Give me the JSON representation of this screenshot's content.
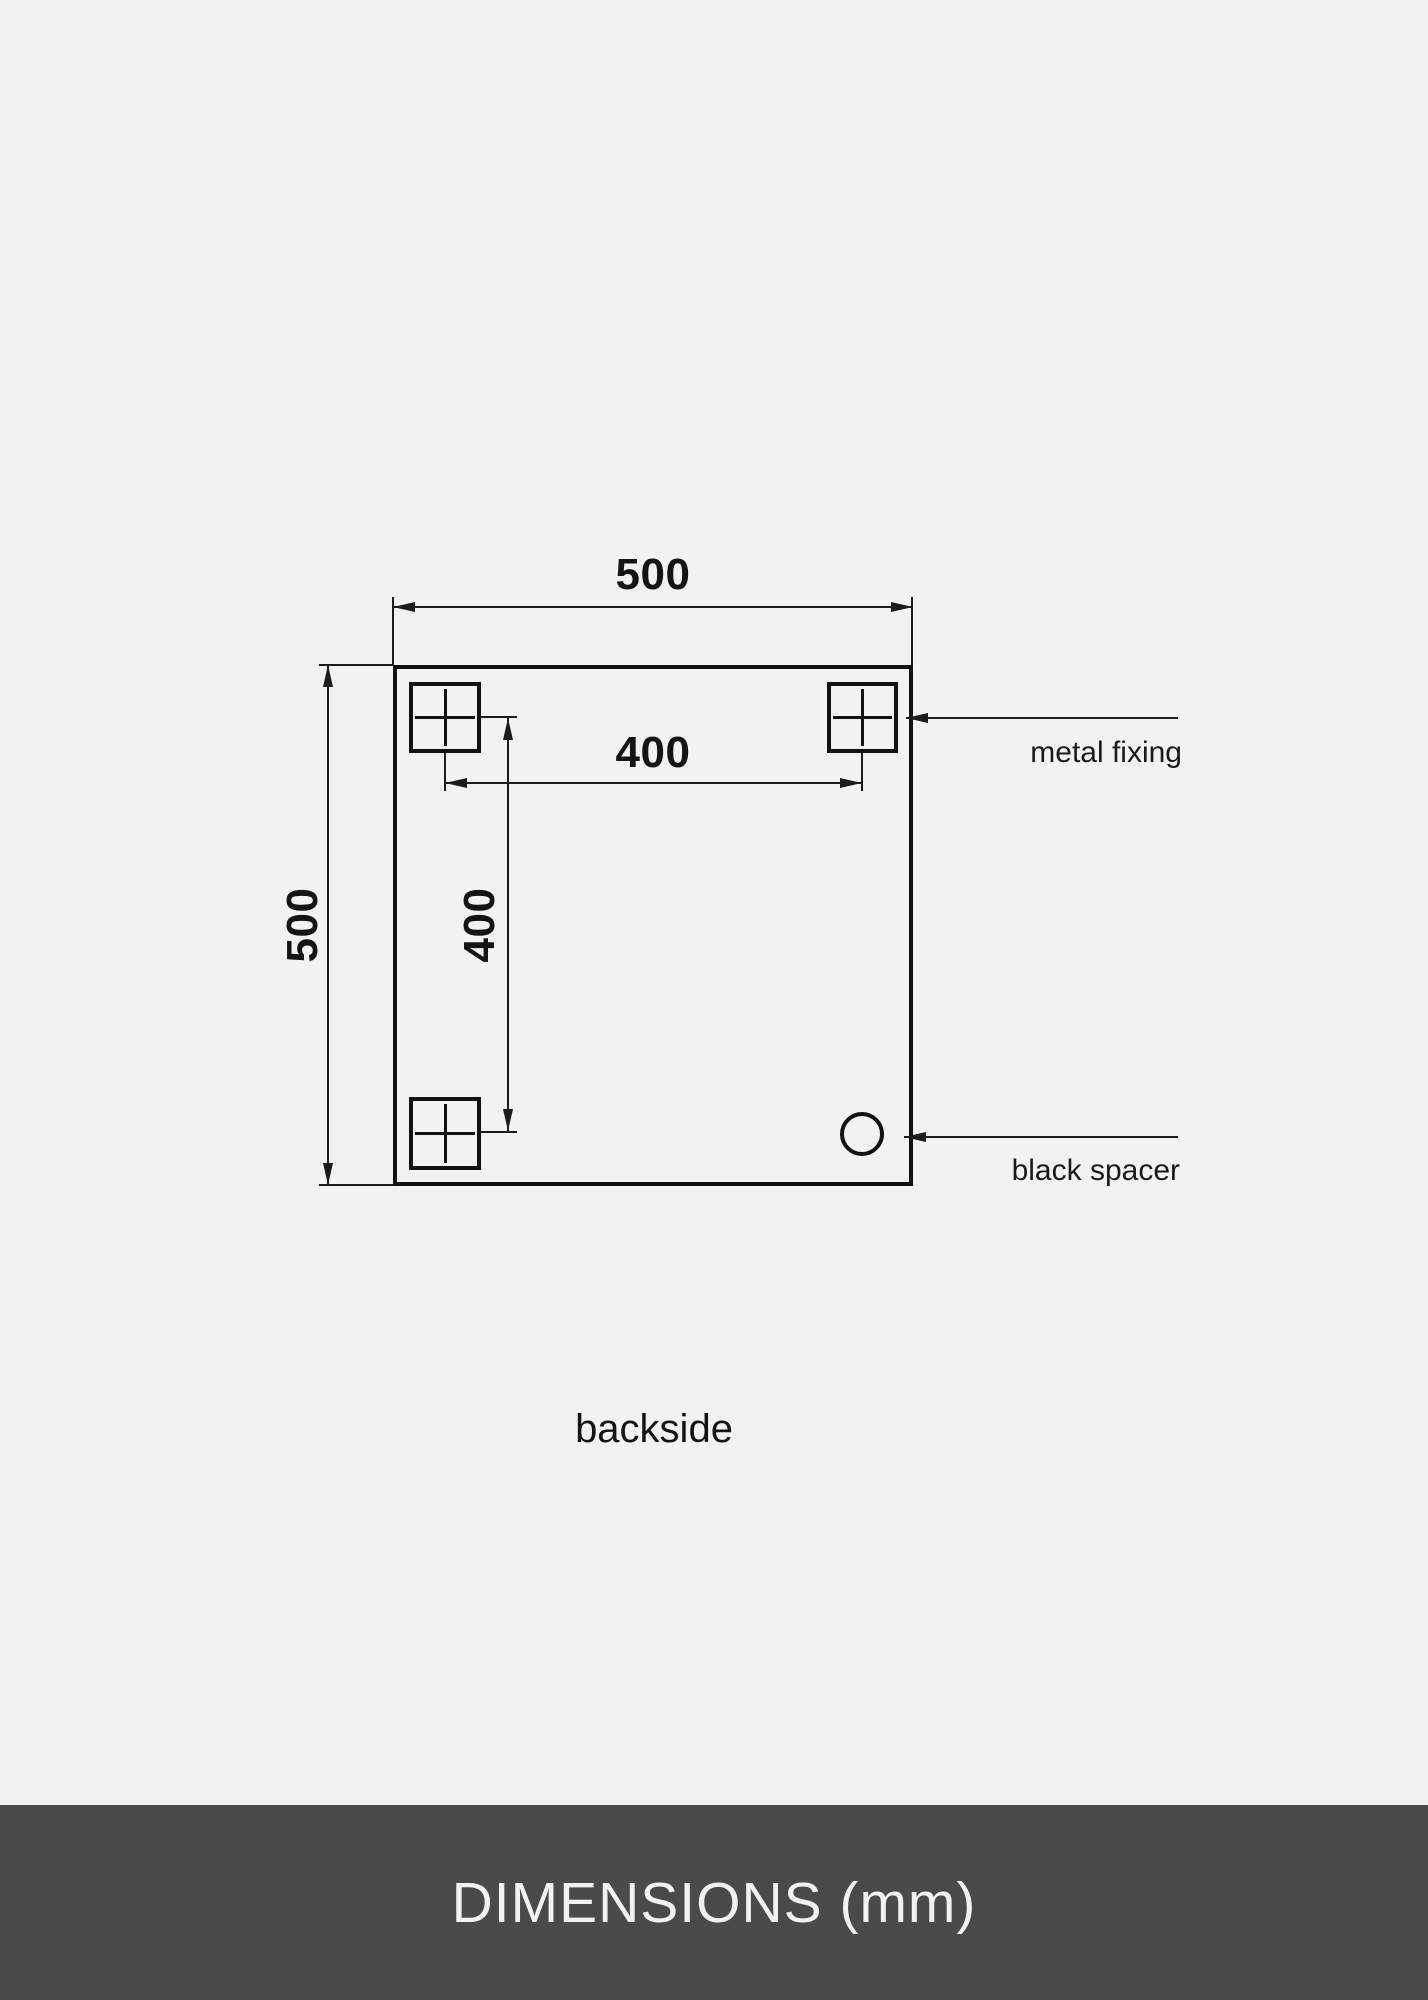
{
  "page": {
    "background_color": "#f2f2f0",
    "line_color": "#1a1a1a"
  },
  "drawing": {
    "caption": "backside",
    "dimensions": {
      "overall_width": "500",
      "overall_height": "500",
      "fixing_spacing_horizontal": "400",
      "fixing_spacing_vertical": "400"
    },
    "annotations": {
      "metal_fixing": "metal fixing",
      "black_spacer": "black spacer"
    }
  },
  "footer": {
    "title": "DIMENSIONS (mm)",
    "bar_color": "#4a4a48",
    "text_color": "#f2f2f0"
  }
}
